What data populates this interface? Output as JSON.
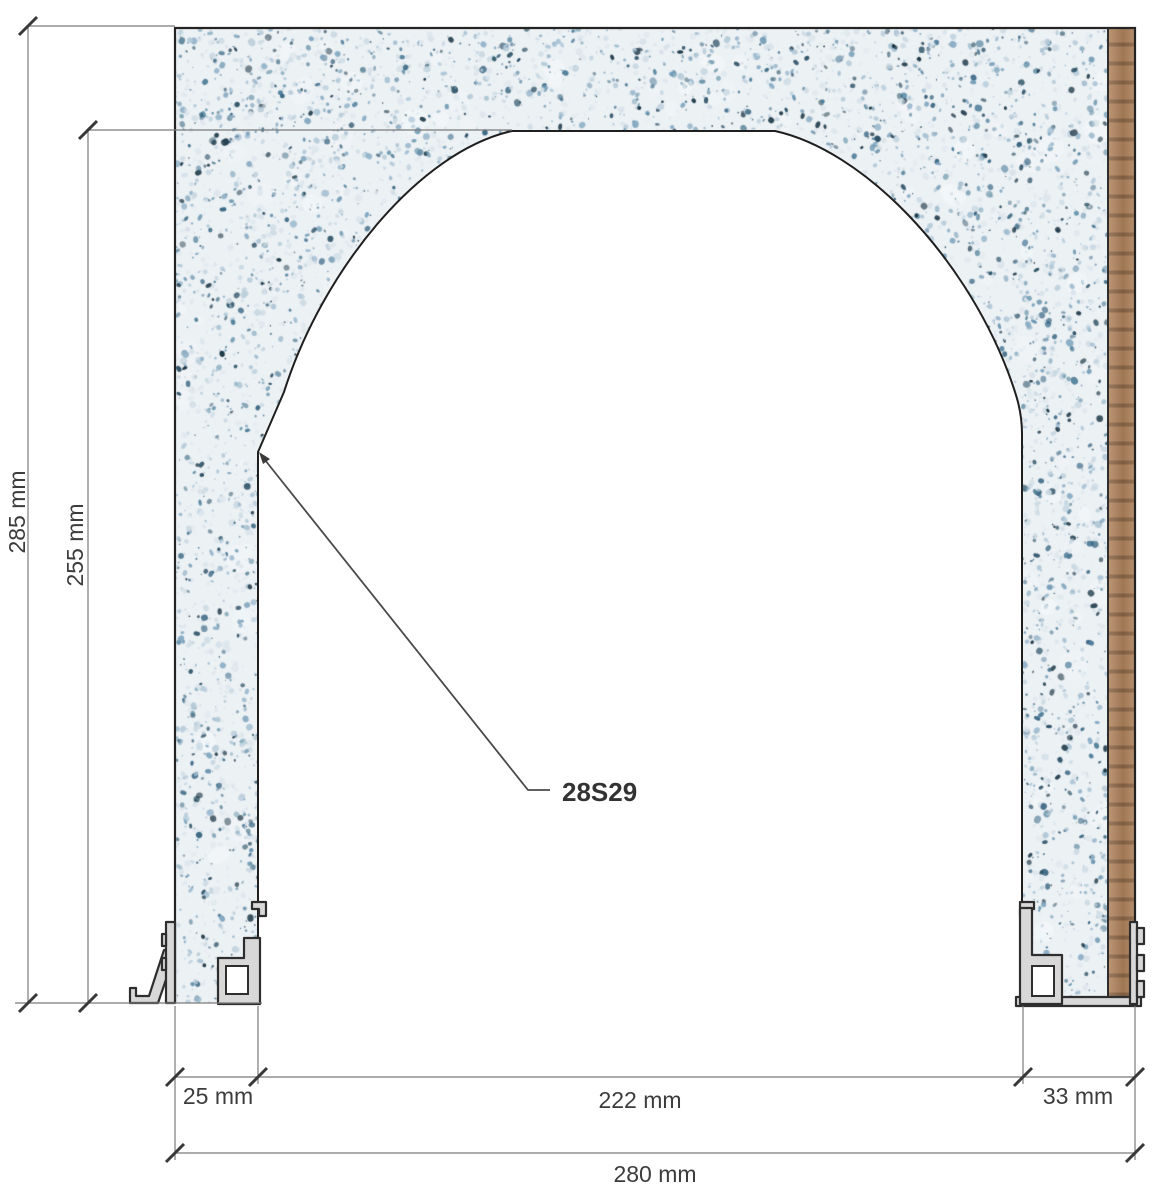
{
  "annotations": {
    "part_label": "28S29",
    "dimensions": {
      "overall_height": "285 mm",
      "opening_height": "255 mm",
      "left_jamb_width": "25 mm",
      "opening_width": "222 mm",
      "right_jamb_width": "33 mm",
      "overall_width": "280 mm"
    }
  },
  "colors": {
    "background": "#ffffff",
    "dimension_line": "#7a7a7a",
    "tick": "#383838",
    "text": "#3c3c3c",
    "leader": "#4a4a4a",
    "panel_outline": "#242424",
    "profile_fill": "#d8d8d8",
    "profile_stroke": "#2e2e2e",
    "wood_base": "#b2855f",
    "wood_grain": "#65482f",
    "terrazzo_base": "#ecf1f4",
    "terrazzo_patch": "#f4f7f9",
    "terrazzo_palette": [
      "#dde6ec",
      "#cbd9e2",
      "#b6cbd9",
      "#9bb9cd",
      "#7fa5bf",
      "#6592ad",
      "#4b7b97",
      "#35637f",
      "#22485e",
      "#132f3f"
    ]
  }
}
